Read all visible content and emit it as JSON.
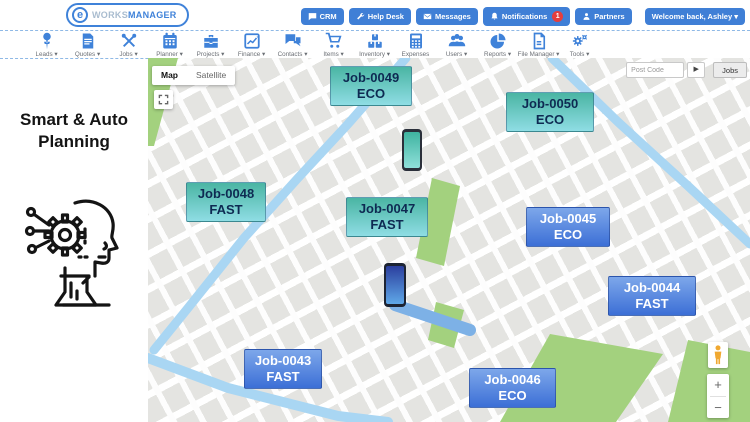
{
  "header": {
    "logo": {
      "icon_letter": "e",
      "brand_first": "WORKS",
      "brand_second": "MANAGER"
    },
    "buttons": [
      {
        "label": "CRM",
        "icon": "chat-icon"
      },
      {
        "label": "Help Desk",
        "icon": "wrench-icon"
      },
      {
        "label": "Messages",
        "icon": "envelope-icon"
      },
      {
        "label": "Notifications",
        "icon": "bell-icon",
        "badge": "1"
      },
      {
        "label": "Partners",
        "icon": "person-icon"
      }
    ],
    "welcome": "Welcome back, Ashley ▾"
  },
  "nav": {
    "items": [
      {
        "label": "Leads ▾",
        "icon": "pushpin-icon"
      },
      {
        "label": "Quotes ▾",
        "icon": "document-icon"
      },
      {
        "label": "Jobs ▾",
        "icon": "tools-cross-icon"
      },
      {
        "label": "Planner ▾",
        "icon": "calendar-icon"
      },
      {
        "label": "Projects ▾",
        "icon": "briefcase-icon"
      },
      {
        "label": "Finance ▾",
        "icon": "chart-icon"
      },
      {
        "label": "Contacts ▾",
        "icon": "speech-bubbles-icon"
      },
      {
        "label": "Items ▾",
        "icon": "cart-icon"
      },
      {
        "label": "Inventory ▾",
        "icon": "boxes-icon"
      },
      {
        "label": "Expenses",
        "icon": "calculator-icon"
      },
      {
        "label": "Users ▾",
        "icon": "users-icon"
      },
      {
        "label": "Reports ▾",
        "icon": "pie-chart-icon"
      },
      {
        "label": "File Manager ▾",
        "icon": "file-icon"
      },
      {
        "label": "Tools ▾",
        "icon": "gears-icon"
      }
    ]
  },
  "sidebar": {
    "title_line1": "Smart & Auto",
    "title_line2": "Planning",
    "icon": "smart-planning-head-gear-icon"
  },
  "map": {
    "type_control": {
      "map_label": "Map",
      "satellite_label": "Satellite"
    },
    "search": {
      "placeholder": "Post Code",
      "run_label": "▶",
      "jobs_button": "Jobs"
    },
    "zoom": {
      "in": "+",
      "out": "−"
    },
    "jobs": [
      {
        "id": "Job-0049",
        "tag": "ECO",
        "theme": "teal"
      },
      {
        "id": "Job-0050",
        "tag": "ECO",
        "theme": "teal"
      },
      {
        "id": "Job-0048",
        "tag": "FAST",
        "theme": "teal"
      },
      {
        "id": "Job-0047",
        "tag": "FAST",
        "theme": "teal"
      },
      {
        "id": "Job-0045",
        "tag": "ECO",
        "theme": "blue"
      },
      {
        "id": "Job-0044",
        "tag": "FAST",
        "theme": "blue"
      },
      {
        "id": "Job-0043",
        "tag": "FAST",
        "theme": "blue"
      },
      {
        "id": "Job-0046",
        "tag": "ECO",
        "theme": "blue"
      }
    ],
    "markers": [
      {
        "name": "phone-marker-teal",
        "theme": "teal"
      },
      {
        "name": "phone-marker-blue",
        "theme": "blue"
      }
    ],
    "colors": {
      "accent": "#3f82d9",
      "teal_top": "#4ab5a3",
      "teal_bottom": "#8fdde4",
      "blue_top": "#7da7ea",
      "blue_bottom": "#3c6fd6",
      "water": "#a9d6f3",
      "park": "#a3d17e",
      "badge_red": "#e53e3e"
    }
  }
}
